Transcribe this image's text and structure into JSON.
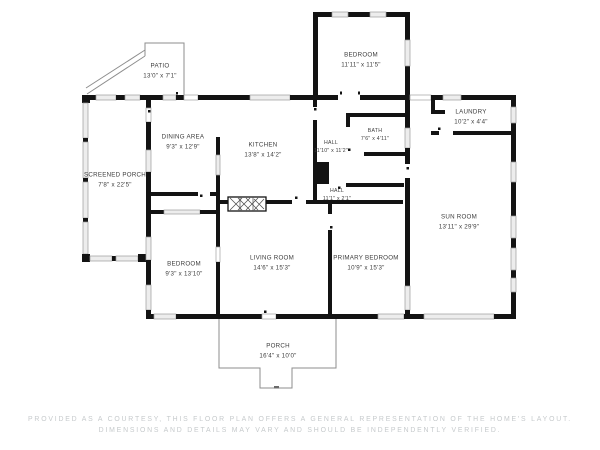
{
  "document": {
    "kind": "residential floor plan drawing",
    "background": "#ffffff"
  },
  "colors": {
    "wall": "#131313",
    "window_fill": "#ededed",
    "window_stroke": "#9b9b9b",
    "thin_outline": "#8d8d8d",
    "room_label": "#3d3d3d",
    "disclaimer": "#c6cacc"
  },
  "rooms": {
    "bedroom_top": {
      "name": "BEDROOM",
      "dims": "11'11\" x 11'5\""
    },
    "patio": {
      "name": "PATIO",
      "dims": "13'0\" x 7'1\""
    },
    "dining_area": {
      "name": "DINING AREA",
      "dims": "9'3\" x 12'9\""
    },
    "kitchen": {
      "name": "KITCHEN",
      "dims": "13'8\" x 14'2\""
    },
    "hall": {
      "name": "HALL",
      "dims": "11'10\" x 11'2\""
    },
    "bath": {
      "name": "BATH",
      "dims": "7'6\" x 4'11\""
    },
    "laundry": {
      "name": "LAUNDRY",
      "dims": "10'2\" x 4'4\""
    },
    "screened_porch": {
      "name": "SCREENED PORCH",
      "dims": "7'8\" x 22'5\""
    },
    "hall_small": {
      "name": "HALL",
      "dims": "11'1\" x 2'1\""
    },
    "sun_room": {
      "name": "SUN ROOM",
      "dims": "13'11\" x 29'9\""
    },
    "bedroom_bottom": {
      "name": "BEDROOM",
      "dims": "9'3\" x 13'10\""
    },
    "living_room": {
      "name": "LIVING ROOM",
      "dims": "14'6\" x 15'3\""
    },
    "primary_bedroom": {
      "name": "PRIMARY BEDROOM",
      "dims": "10'9\" x 15'3\""
    },
    "porch": {
      "name": "PORCH",
      "dims": "16'4\" x 10'0\""
    }
  },
  "disclaimer": {
    "line1": "PROVIDED AS A COURTESY, THIS FLOOR PLAN OFFERS A GENERAL REPRESENTATION OF THE HOME'S LAYOUT.",
    "line2": "DIMENSIONS AND DETAILS MAY VARY AND SHOULD BE INDEPENDENTLY VERIFIED."
  }
}
